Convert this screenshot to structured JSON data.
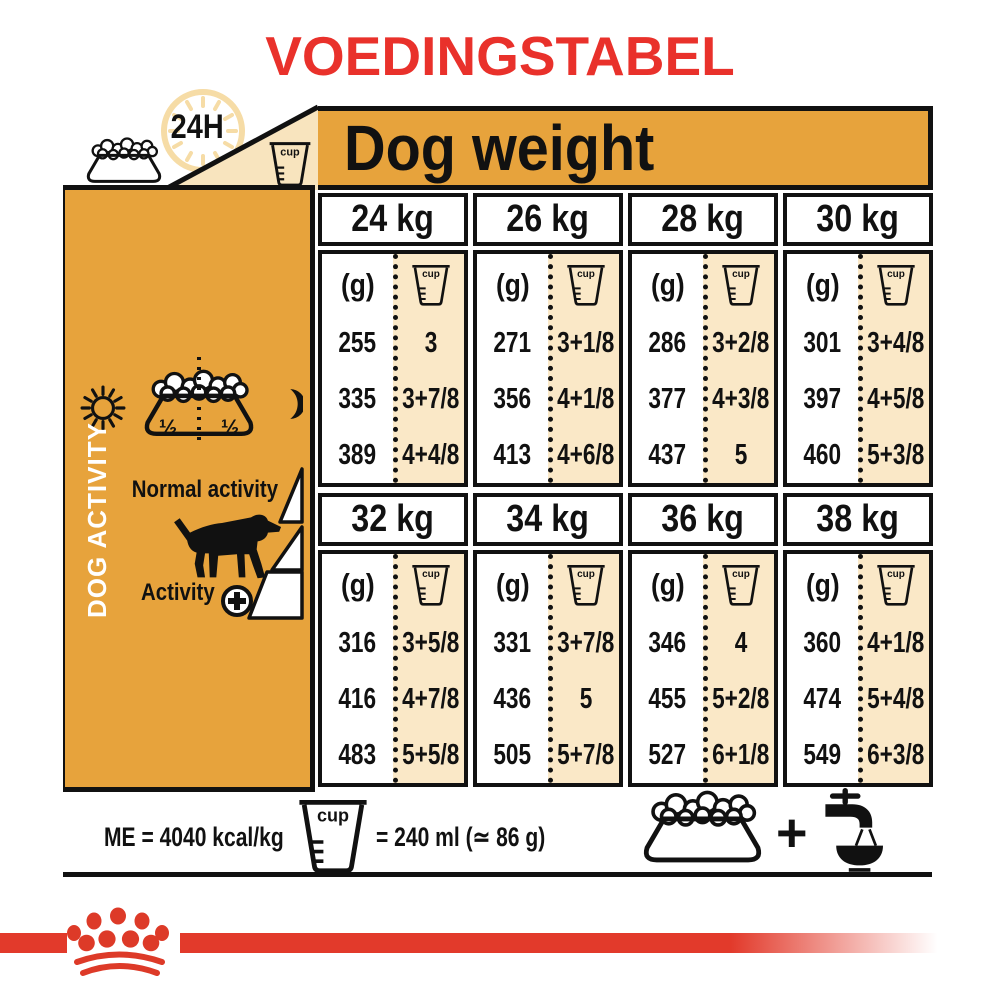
{
  "title": "VOEDINGSTABEL",
  "header": {
    "hours_label": "24H",
    "dog_weight_label": "Dog weight",
    "cup_label": "cup"
  },
  "sidebar": {
    "dog_activity_label": "DOG ACTIVITY",
    "normal_activity_label": "Normal activity",
    "activity_plus_label": "Activity",
    "half_left": "½",
    "half_right": "½"
  },
  "table": {
    "grams_header": "(g)",
    "sections": [
      {
        "weights": [
          {
            "label": "24 kg",
            "grams": [
              "255",
              "335",
              "389"
            ],
            "cups": [
              "3",
              "3+7/8",
              "4+4/8"
            ]
          },
          {
            "label": "26 kg",
            "grams": [
              "271",
              "356",
              "413"
            ],
            "cups": [
              "3+1/8",
              "4+1/8",
              "4+6/8"
            ]
          },
          {
            "label": "28 kg",
            "grams": [
              "286",
              "377",
              "437"
            ],
            "cups": [
              "3+2/8",
              "4+3/8",
              "5"
            ]
          },
          {
            "label": "30 kg",
            "grams": [
              "301",
              "397",
              "460"
            ],
            "cups": [
              "3+4/8",
              "4+5/8",
              "5+3/8"
            ]
          }
        ]
      },
      {
        "weights": [
          {
            "label": "32 kg",
            "grams": [
              "316",
              "416",
              "483"
            ],
            "cups": [
              "3+5/8",
              "4+7/8",
              "5+5/8"
            ]
          },
          {
            "label": "34 kg",
            "grams": [
              "331",
              "436",
              "505"
            ],
            "cups": [
              "3+7/8",
              "5",
              "5+7/8"
            ]
          },
          {
            "label": "36 kg",
            "grams": [
              "346",
              "455",
              "527"
            ],
            "cups": [
              "4",
              "5+2/8",
              "6+1/8"
            ]
          },
          {
            "label": "38 kg",
            "grams": [
              "360",
              "474",
              "549"
            ],
            "cups": [
              "4+1/8",
              "5+4/8",
              "6+3/8"
            ]
          }
        ]
      }
    ]
  },
  "footer": {
    "me_label": "ME = 4040 kcal/kg",
    "cup_equals_label": "= 240 ml (≃ 86 g)",
    "plus_symbol": "+"
  },
  "colors": {
    "orange": "#E7A33C",
    "cream": "#FAE8C7",
    "triangle_cream": "#F8E4BE",
    "clock_ring": "#F6DCA6",
    "red_title": "#E9312B",
    "red_bar": "#E23A2B",
    "black": "#111111"
  }
}
